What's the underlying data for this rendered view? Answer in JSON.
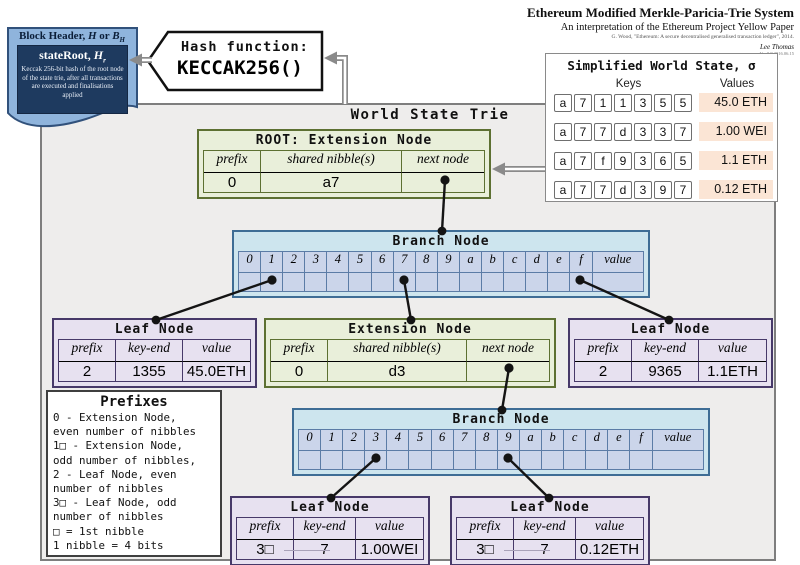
{
  "doc": {
    "title": "Ethereum Modified Merkle-Paricia-Trie System",
    "subtitle": "An interpretation of the Ethereum Project Yellow Paper",
    "citation": "G. Wood, \"Ethereum: A secure decentralised generalised transaction ledger\", 2014.",
    "author": "Lee Thomas",
    "version": "Ver 0.8 2016.06.15"
  },
  "block_header": {
    "title_main": "Block Header,",
    "title_var1": "H",
    "title_or": "or",
    "title_var2": "B",
    "title_var2_sub": "H",
    "stateroot_label": "stateRoot,",
    "stateroot_var": "H",
    "stateroot_sub": "r",
    "description": "Keccak 256-bit hash of the root node of the state trie, after all transactions are executed and finalisations applied"
  },
  "hash_box": {
    "label": "Hash function:",
    "function": "KECCAK256()"
  },
  "world_state": {
    "title": "Simplified World State, σ",
    "keys_header": "Keys",
    "values_header": "Values",
    "rows": [
      {
        "key": [
          "a",
          "7",
          "1",
          "1",
          "3",
          "5",
          "5"
        ],
        "value": "45.0 ETH"
      },
      {
        "key": [
          "a",
          "7",
          "7",
          "d",
          "3",
          "3",
          "7"
        ],
        "value": "1.00 WEI"
      },
      {
        "key": [
          "a",
          "7",
          "f",
          "9",
          "3",
          "6",
          "5"
        ],
        "value": "1.1 ETH"
      },
      {
        "key": [
          "a",
          "7",
          "7",
          "d",
          "3",
          "9",
          "7"
        ],
        "value": "0.12 ETH"
      }
    ]
  },
  "trie": {
    "title": "World State Trie",
    "root_extension": {
      "title": "ROOT: Extension Node",
      "headers": [
        "prefix",
        "shared nibble(s)",
        "next node"
      ],
      "prefix": "0",
      "shared_nibbles": "a7",
      "next_node": ""
    },
    "branch1": {
      "title": "Branch Node",
      "slots": [
        "0",
        "1",
        "2",
        "3",
        "4",
        "5",
        "6",
        "7",
        "8",
        "9",
        "a",
        "b",
        "c",
        "d",
        "e",
        "f",
        "value"
      ],
      "pointer_slots": [
        "1",
        "7",
        "f"
      ]
    },
    "leaf_left": {
      "title": "Leaf Node",
      "headers": [
        "prefix",
        "key-end",
        "value"
      ],
      "prefix": "2",
      "key_end": "1355",
      "value": "45.0ETH"
    },
    "extension": {
      "title": "Extension Node",
      "headers": [
        "prefix",
        "shared nibble(s)",
        "next node"
      ],
      "prefix": "0",
      "shared_nibbles": "d3",
      "next_node": ""
    },
    "leaf_right": {
      "title": "Leaf Node",
      "headers": [
        "prefix",
        "key-end",
        "value"
      ],
      "prefix": "2",
      "key_end": "9365",
      "value": "1.1ETH"
    },
    "branch2": {
      "title": "Branch Node",
      "slots": [
        "0",
        "1",
        "2",
        "3",
        "4",
        "5",
        "6",
        "7",
        "8",
        "9",
        "a",
        "b",
        "c",
        "d",
        "e",
        "f",
        "value"
      ],
      "pointer_slots": [
        "3",
        "9"
      ]
    },
    "leaf_bottom_left": {
      "title": "Leaf Node",
      "headers": [
        "prefix",
        "key-end",
        "value"
      ],
      "prefix": "3□",
      "key_end": "7",
      "value": "1.00WEI"
    },
    "leaf_bottom_right": {
      "title": "Leaf Node",
      "headers": [
        "prefix",
        "key-end",
        "value"
      ],
      "prefix": "3□",
      "key_end": "7",
      "value": "0.12ETH"
    }
  },
  "prefixes": {
    "title": "Prefixes",
    "lines": [
      "0 - Extension Node,",
      "even number of nibbles",
      "1□ - Extension Node,",
      "odd number of nibbles,",
      "2 - Leaf Node, even",
      "number of nibbles",
      "3□ - Leaf Node, odd",
      "number of nibbles",
      "□ = 1st nibble",
      "1 nibble = 4 bits"
    ]
  },
  "colors": {
    "extension_border": "#5d7032",
    "extension_fill": "#e9efda",
    "branch_border": "#3e6d95",
    "branch_fill": "#cde5ee",
    "branch_cell_fill": "#cbd5ea",
    "branch_inner": "#5b7ca6",
    "leaf_border": "#473969",
    "leaf_fill": "#e7e1f0",
    "value_badge": "#fbe5d5",
    "header_navy": "#1e3a5f",
    "banner_blue": "#8fb4dc"
  }
}
